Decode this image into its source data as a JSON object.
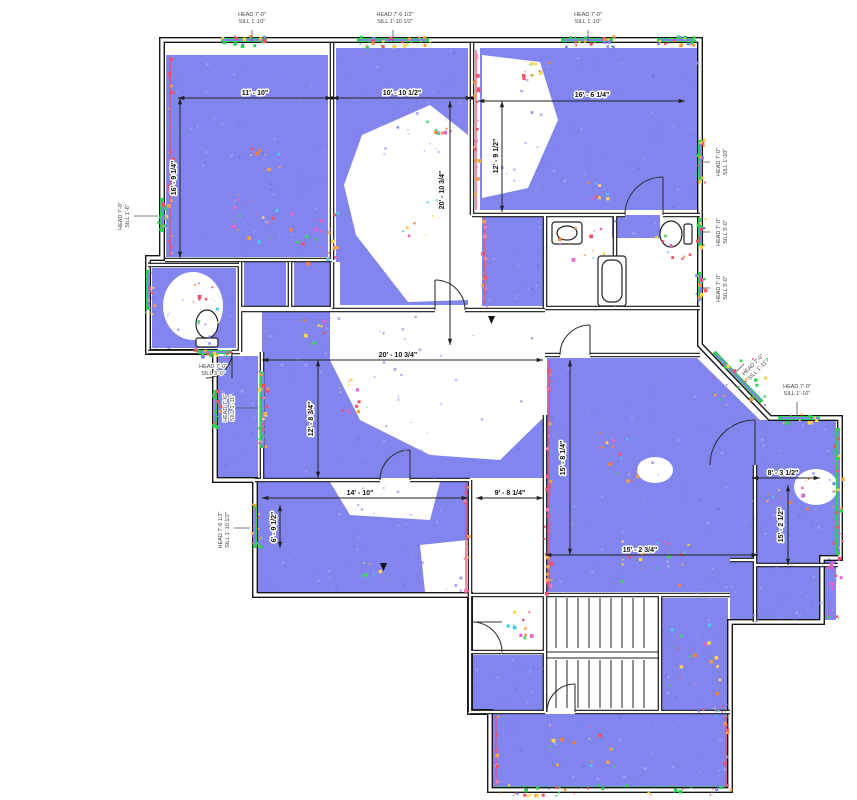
{
  "colors": {
    "point_cloud": "#8285ee",
    "point_cloud_light": "#9b9ef5",
    "wall": "#161616",
    "window_green": "#2fcf54",
    "scan_red": "#f34f6b",
    "scan_orange": "#ffa040",
    "scan_magenta": "#e664cc"
  },
  "dimensions": {
    "top_room_left_width": "11' - 10\"",
    "top_room_mid_width": "10' - 10 1/2\"",
    "top_room_right_width": "16' - 6 1/4\"",
    "top_room_left_height": "16' - 9 1/4\"",
    "top_room_right_height": "12' - 9 1/2\"",
    "upper_span_height": "20' - 10 3/4\"",
    "living_width": "20' - 10 3/4\"",
    "living_height": "12' - 8 3/4\"",
    "dining_height": "15' - 8 1/4\"",
    "bottom_room_width": "14' - 10\"",
    "bottom_mid_width": "9' - 8 1/4\"",
    "bottom_right_width": "15' - 2 3/4\"",
    "right_wing_width": "8' - 3 1/2\"",
    "right_wing_height": "15' - 2 1/2\"",
    "bottom_room_window_height": "6' - 9 1/2\""
  },
  "window_labels": {
    "top_1": {
      "head": "HEAD 7'-0\"",
      "sill": "SILL 1'-10\""
    },
    "top_2": {
      "head": "HEAD 7'-6 1/2\"",
      "sill": "SILL 1'-10 1/2\""
    },
    "top_3": {
      "head": "HEAD 7'-0\"",
      "sill": "SILL 1'-10\""
    },
    "left_1": {
      "head": "HEAD 7'-0\"",
      "sill": "SILL 1'-6\""
    },
    "left_2": {
      "head": "HEAD 7'-0\"",
      "sill": "SILL 3'-0\""
    },
    "left_3": {
      "head": "HEAD 7'-6\"",
      "sill": "SILL 1'-11\""
    },
    "left_4": {
      "head": "HEAD 7'-6 1/2\"",
      "sill": "SILL 1'-10 1/2\""
    },
    "right_1": {
      "head": "HEAD 7'-0\"",
      "sill": "SILL 1'-10\""
    },
    "right_2": {
      "head": "HEAD 7'-0\"",
      "sill": "SILL 3'-0\""
    },
    "right_3": {
      "head": "HEAD 7'-0\"",
      "sill": "SILL 3'-0\""
    },
    "right_diag": {
      "head": "HEAD 7'-0\"",
      "sill": "SILL 1'-11\""
    },
    "right_4": {
      "head": "HEAD 7'-0\"",
      "sill": "SILL 1'-10\""
    }
  }
}
